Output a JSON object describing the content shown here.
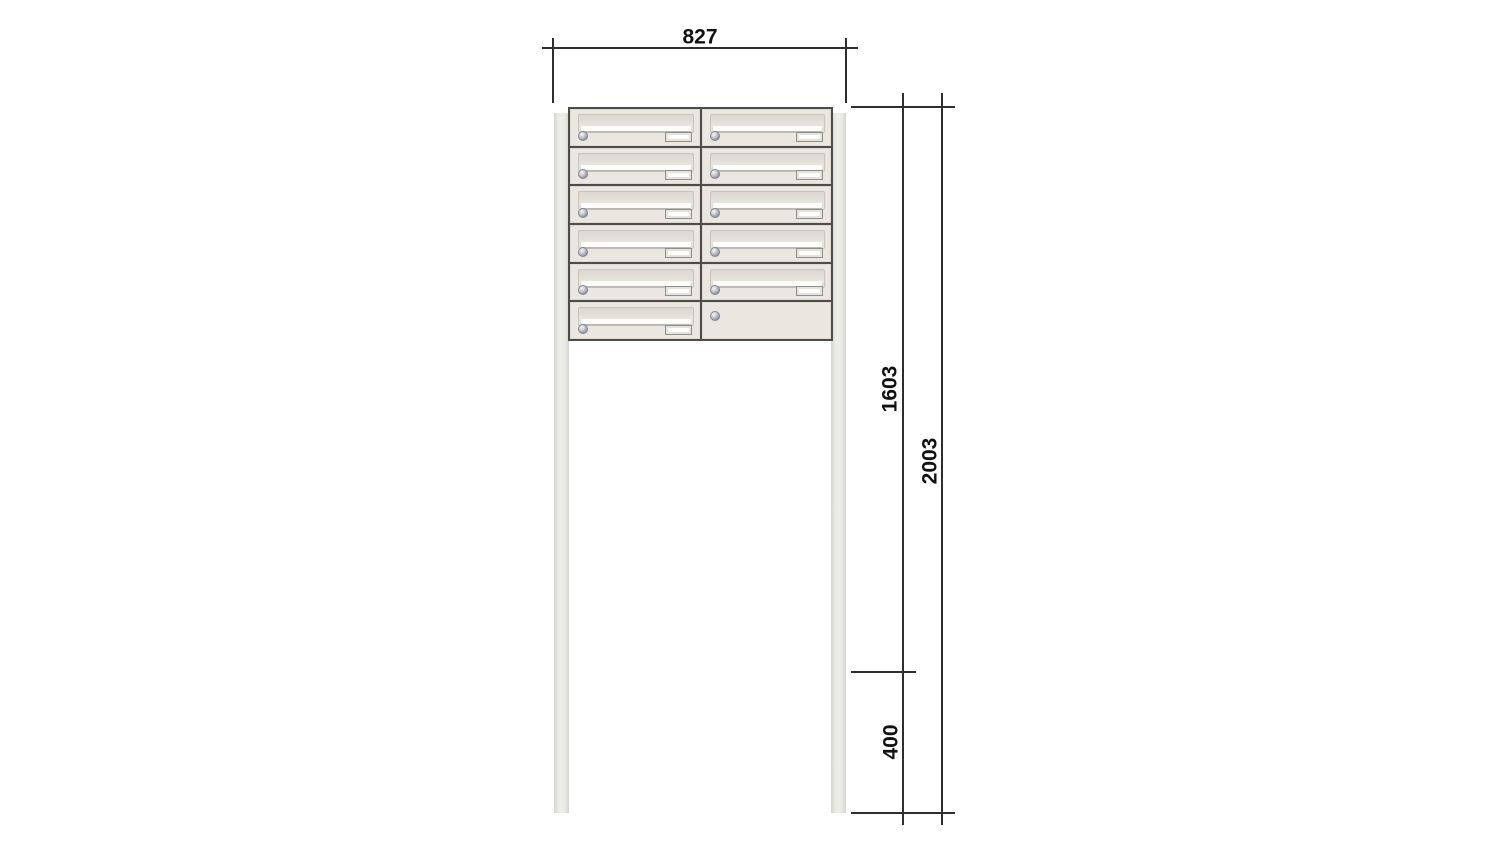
{
  "diagram": {
    "type": "product dimension drawing",
    "subject": "free-standing letterbox unit on two posts",
    "background": "#ffffff"
  },
  "dimensions": {
    "width": {
      "label": "827"
    },
    "upper_height": {
      "label": "1603"
    },
    "total_height": {
      "label": "2003"
    },
    "lower_height": {
      "label": "400"
    }
  },
  "unit": {
    "rows": 6,
    "columns": 2,
    "mailbox_count": 11,
    "blank_panel_count": 1,
    "cells": [
      [
        "mailbox",
        "mailbox"
      ],
      [
        "mailbox",
        "mailbox"
      ],
      [
        "mailbox",
        "mailbox"
      ],
      [
        "mailbox",
        "mailbox"
      ],
      [
        "mailbox",
        "mailbox"
      ],
      [
        "mailbox",
        "blank"
      ]
    ]
  },
  "colors": {
    "cabinet_body": "#eae7e0",
    "flap": "#e0ddd6",
    "slot": "#fcfcfb",
    "post": "#e5e5df",
    "divider": "#4c4c48",
    "dimension_line": "#2e2e2e",
    "label_text": "#111111"
  }
}
